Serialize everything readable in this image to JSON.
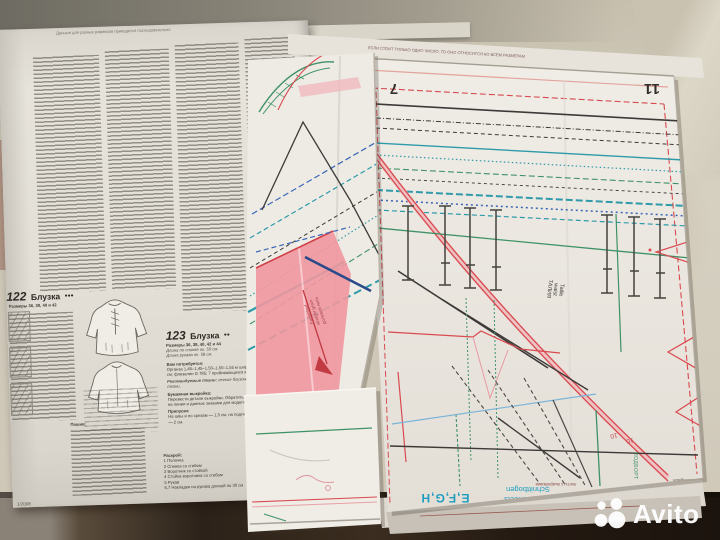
{
  "photo": {
    "watermark": "Avito"
  },
  "colors": {
    "edge_cyan": "#1f9dc0",
    "pattern_red": "#d84a50",
    "pattern_pink": "#ef979e",
    "pattern_teal": "#2e9aaa",
    "pattern_green": "#3f9267",
    "table_dark": "#241a12"
  },
  "page": {
    "header_note_left": "Данные для разных размеров приводятся последовательно",
    "header_note_right": "ЕСЛИ СТОИТ ТОЛЬКО ОДНО ЧИСЛО, ТО ОНО ОТНОСИТСЯ КО ВСЕМ РАЗМЕРАМ",
    "footer_issue": "1/2008",
    "model_122": {
      "number": "122",
      "title": "Блузка",
      "difficulty": "●●●",
      "sizes_line": "Размеры 36, 38, 40 и 42",
      "sew_label": "Пошив:"
    },
    "model_123": {
      "number": "123",
      "title": "Блузка",
      "difficulty": "●●",
      "sizes_line": "Размеры 36, 38, 40, 42 и 44",
      "length_back": "Длина по спинке ок. 50 см.",
      "length_sleeve": "Длина рукава ок. 58 см.",
      "need_label": "Вам потребуется:",
      "need_text": "Органза 1,45–1,45–1,50–1,50–1,55 м шириной 145 см; флизелин G 785; 7 пробивающихся кнопок.",
      "fabrics_label": "Рекомендуемые ткани:",
      "fabrics_text": "легкие блузочные ткани.",
      "paper_label": "Бумажная выкройка:",
      "paper_text": "Перевести детали выкройки. Обратить внимание на линии и данные знаками для модели 123.",
      "allow_label": "Припуски:",
      "allow_text": "На швы и по срезам — 1,5 см, на подгибку низа — 2 см.",
      "cut_label": "Раскрой:",
      "cutting": [
        {
          "item": "1 Полочка",
          "qty": "2x"
        },
        {
          "item": "2 Спинка со сгибом",
          "qty": "1x"
        },
        {
          "item": "3 Воротник со стойкой",
          "qty": "2x"
        },
        {
          "item": "4 Стойка воротника со сгибом",
          "qty": "2x"
        },
        {
          "item": "5 Рукав",
          "qty": "2x"
        },
        {
          "item": "6,7 Накладки на рукава длиной по 30 см",
          "qty": ""
        }
      ]
    }
  },
  "sheet": {
    "num_left": "7",
    "num_right": "11",
    "size_mark_a": "10",
    "size_mark_b": "10",
    "waist_de": "Taille",
    "waist_en": "waist",
    "waist_ru": "ТАЛИЯ",
    "grain_de": "Fadenlauf",
    "grain_en": "straight grain",
    "grain_ru": "долевая нить",
    "facing_ru": "ПОДБОРТ",
    "edge_letters": "E,F,G,H",
    "edge_de": "Schnittbogen",
    "edge_en": "pattern sheets",
    "edge_ru": "листы с выкройками",
    "edge_brand": "burda",
    "edge_issue": "1/08",
    "edge_langs": "deutsch/englisch"
  }
}
